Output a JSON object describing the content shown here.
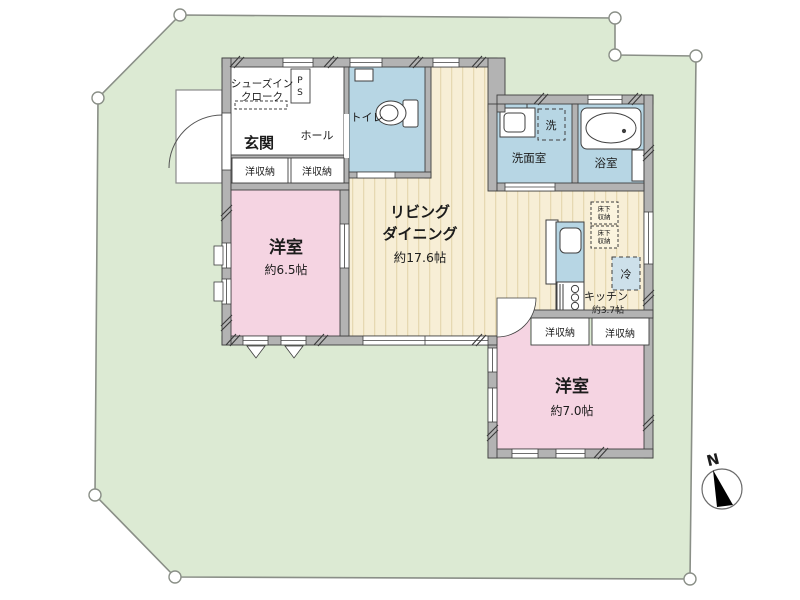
{
  "plan_title": "floor-plan",
  "compass": {
    "label": "N"
  },
  "colors": {
    "lot": "#dcead3",
    "lot_stroke": "#8a8f87",
    "wall": "#b3b3b3",
    "wall_stroke": "#3f3f3f",
    "floor": "#f7eed6",
    "floor_stripe": "#e6d8b2",
    "pink": "#f5d4e2",
    "blue": "#b7d6e4",
    "white": "#ffffff"
  },
  "rooms": {
    "shoe_closet": {
      "line1": "シューズイン",
      "line2": "クローク"
    },
    "ps": {
      "line1": "P",
      "line2": "S"
    },
    "genkan": {
      "label": "玄関"
    },
    "hall": {
      "label": "ホール"
    },
    "toilet": {
      "label": "トイレ"
    },
    "closet_a": {
      "label": "洋収納"
    },
    "closet_b": {
      "label": "洋収納"
    },
    "bedroom1": {
      "label": "洋室",
      "size": "約6.5帖"
    },
    "living": {
      "line1": "リビング",
      "line2": "ダイニング",
      "size": "約17.6帖"
    },
    "washroom": {
      "label": "洗面室"
    },
    "washer": {
      "label": "洗"
    },
    "bath": {
      "label": "浴室"
    },
    "kitchen": {
      "label": "キッチン",
      "size": "約3.7帖"
    },
    "fridge": {
      "label": "冷"
    },
    "underfloor_a": {
      "line1": "床下",
      "line2": "収納"
    },
    "underfloor_b": {
      "line1": "床下",
      "line2": "収納"
    },
    "closet_c": {
      "label": "洋収納"
    },
    "closet_d": {
      "label": "洋収納"
    },
    "bedroom2": {
      "label": "洋室",
      "size": "約7.0帖"
    }
  }
}
